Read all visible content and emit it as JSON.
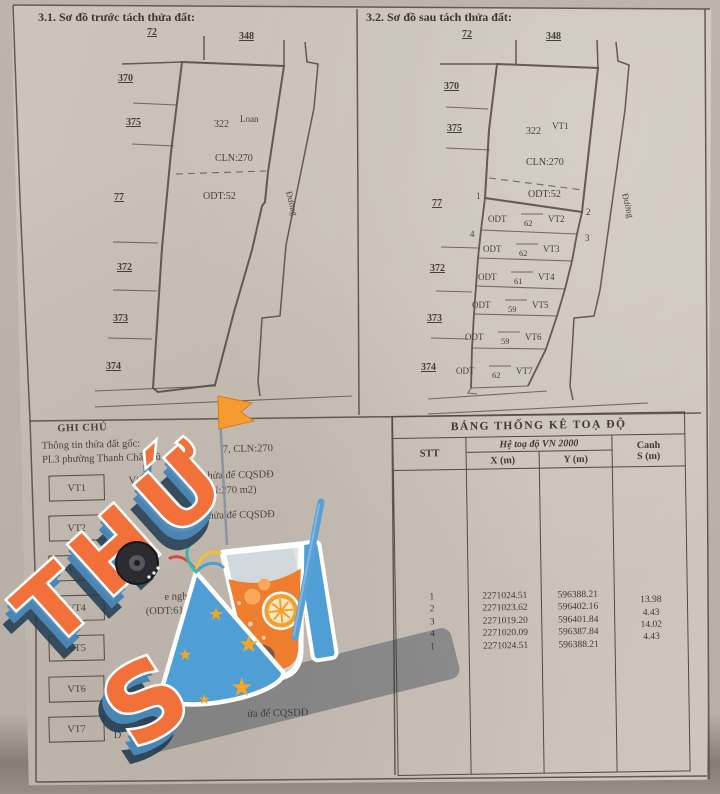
{
  "sections": {
    "before": {
      "title": "3.1. Sơ đồ trước tách thửa đất:",
      "top_labels": [
        "72",
        "348"
      ],
      "left_labels": [
        "370",
        "375",
        "77",
        "372",
        "373",
        "374"
      ],
      "parcel": {
        "number": "322",
        "name": "Loan",
        "use_upper": "CLN:270",
        "use_lower": "ODT:52"
      },
      "road": "Đường"
    },
    "after": {
      "title": "3.2. Sơ đồ sau tách thửa đất:",
      "top_labels": [
        "72",
        "348"
      ],
      "left_labels": [
        "370",
        "375",
        "77",
        "372",
        "373",
        "374"
      ],
      "parcel": {
        "number": "322",
        "name": "VT1",
        "use_upper": "CLN:270",
        "use_lower": "ODT:52"
      },
      "road": "Đường",
      "corners": [
        "1",
        "2",
        "4",
        "3"
      ],
      "strips": [
        {
          "use": "ODT",
          "area": "62",
          "label": "VT2"
        },
        {
          "use": "ODT",
          "area": "62",
          "label": "VT3"
        },
        {
          "use": "ODT",
          "area": "61",
          "label": "VT4"
        },
        {
          "use": "ODT",
          "area": "59",
          "label": "VT5"
        },
        {
          "use": "ODT",
          "area": "59",
          "label": "VT6"
        },
        {
          "use": "ODT",
          "area": "62",
          "label": "VT7"
        }
      ]
    }
  },
  "notes": {
    "title": "GHI CHÚ",
    "subtitle": "Thông tin thửa đất gốc:",
    "origin_left": "PL3 phường Thanh Châu cũ",
    "origin_right": "7, CLN:270",
    "legend_boxes": [
      "VT1",
      "VT2",
      "VT3",
      "VT4",
      "VT5",
      "VT6",
      "VT7"
    ],
    "fragments": {
      "vt1_a": "Vị",
      "vt1_b": "thửa để CQSDĐ",
      "vt1_c": "N:270 m2)",
      "vt2_b": "hửa để CQSDĐ",
      "mid_a": "e ngh",
      "mid_b": "(ODT:61",
      "vt7_a": "Vị",
      "vt7_b": "ửa để CQSDĐ",
      "vt7_c": "D"
    }
  },
  "table": {
    "title": "BẢNG THỐNG KÊ TOẠ ĐỘ",
    "header": {
      "stt": "STT",
      "system": "Hệ toạ độ VN 2000",
      "x": "X (m)",
      "y": "Y (m)",
      "canh1": "Canh",
      "canh2": "S (m)"
    },
    "rows": [
      {
        "stt": "1",
        "x": "2271024.51",
        "y": "596388.21"
      },
      {
        "stt": "2",
        "x": "2271023.62",
        "y": "596402.16"
      },
      {
        "stt": "3",
        "x": "2271019.20",
        "y": "596401.84"
      },
      {
        "stt": "4",
        "x": "2271020.09",
        "y": "596387.84"
      },
      {
        "stt": "1",
        "x": "2271024.51",
        "y": "596388.21"
      }
    ],
    "edges": [
      "13.98",
      "4.43",
      "14.02",
      "4.43"
    ]
  },
  "sticker": {
    "word1": "THỨ",
    "word2_s": "S",
    "colors": {
      "orange": "#f2703a",
      "blue_side": "#4a86b4",
      "navy": "#1f3a52",
      "hat_blue": "#4f9fd6",
      "star": "#f5a623",
      "drink": "#ef7d2e"
    }
  }
}
